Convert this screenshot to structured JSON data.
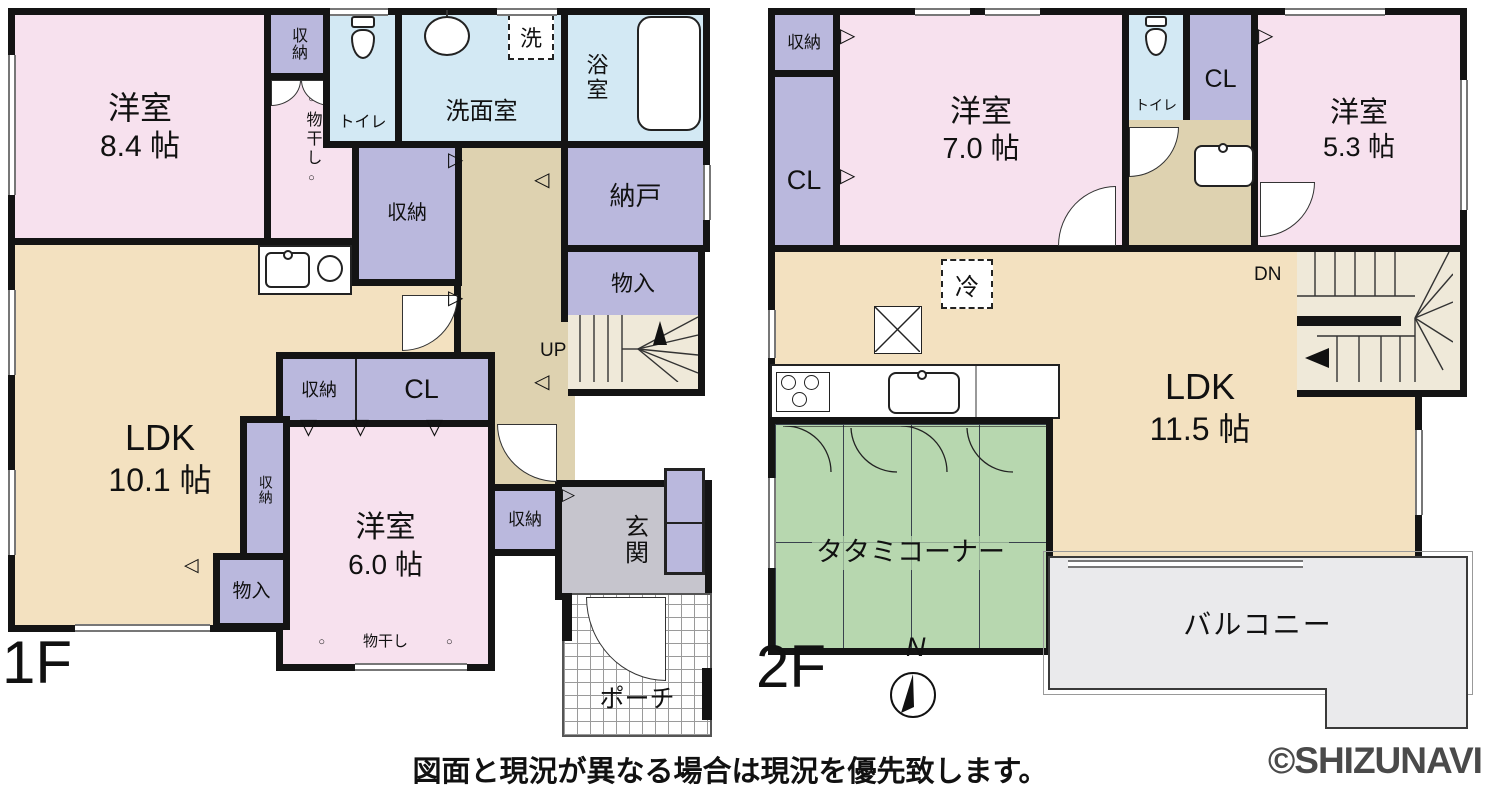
{
  "f1": {
    "label": "1F",
    "r84": {
      "n": "洋室",
      "s": "8.4 帖"
    },
    "sn_top": "収納",
    "monohoshi": "物干し",
    "toilet": "トイレ",
    "senmen": "洗面室",
    "laundry": "洗",
    "bath": "浴室",
    "nando": "納戸",
    "monoiri_a": "物入",
    "sn_mid": "収納",
    "ldk": {
      "n": "LDK",
      "s": "10.1 帖"
    },
    "sn_cl": "収納",
    "cl": "CL",
    "r60": {
      "n": "洋室",
      "s": "6.0 帖"
    },
    "sn_v": "収納",
    "monoiri_b": "物入",
    "sn_genkan": "収納",
    "genkan": "玄関",
    "porch": "ポーチ",
    "up": "UP",
    "monohoshi2": "物干し"
  },
  "f2": {
    "label": "2F",
    "sn": "収納",
    "cl_l": "CL",
    "r70": {
      "n": "洋室",
      "s": "7.0 帖"
    },
    "toilet": "トイレ",
    "cl_r": "CL",
    "r53": {
      "n": "洋室",
      "s": "5.3 帖"
    },
    "ldk": {
      "n": "LDK",
      "s": "11.5 帖"
    },
    "rei": "冷",
    "tatami": "タタミコーナー",
    "dn": "DN",
    "balcony": "バルコニー",
    "north": "N"
  },
  "footer": {
    "disclaimer": "図面と現況が異なる場合は現況を優先致します。",
    "watermark": "©SHIZUNAVI"
  },
  "glyphs": {
    "td": "▽",
    "tr": "▷",
    "tl": "◁",
    "dot": "○"
  },
  "colors": {
    "room_pink": "#f7e1ee",
    "storage_purple": "#bab8dd",
    "wet_blue": "#d3e9f4",
    "ldk_beige": "#f3e1c0",
    "hall_tan": "#ded2b0",
    "tatami_green": "#b7d7af",
    "entry_gray": "#c6c5cd",
    "balcony_gray": "#eaeaec",
    "stairs_cream": "#efe9d9",
    "wall_black": "#141414",
    "watermark_gray": "#4a4a4a"
  }
}
